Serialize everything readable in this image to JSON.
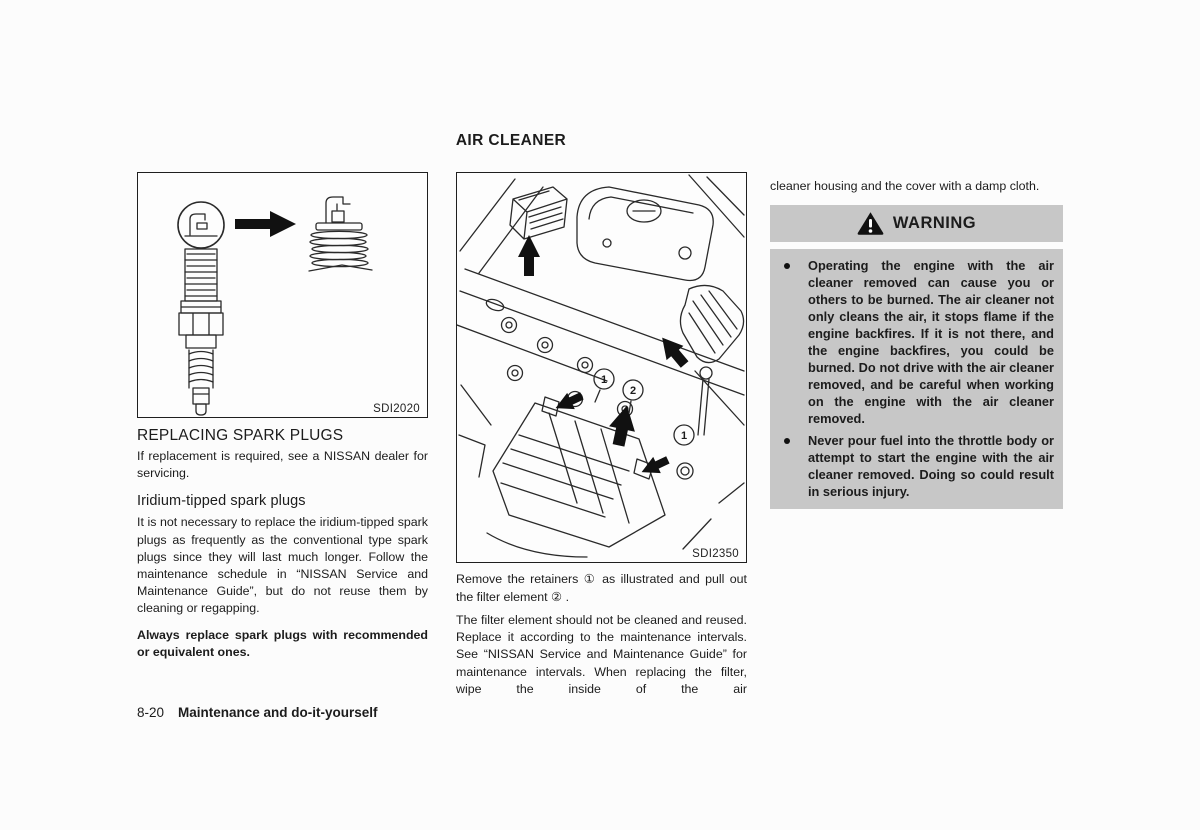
{
  "page": {
    "title": "AIR CLEANER",
    "footer": {
      "page_number": "8-20",
      "chapter": "Maintenance and do-it-yourself"
    }
  },
  "left_column": {
    "figure": {
      "label": "SDI2020"
    },
    "heading": "REPLACING SPARK PLUGS",
    "para1": "If replacement is required, see a NISSAN dealer for servicing.",
    "subheading": "Iridium-tipped spark plugs",
    "para2": "It is not necessary to replace the iridium-tipped spark plugs as frequently as the conventional type spark plugs since they will last much longer. Follow the maintenance schedule in “NISSAN Service and Maintenance Guide”, but do not reuse them by cleaning or regapping.",
    "para3_bold": "Always replace spark plugs with recommended or equivalent ones."
  },
  "middle_column": {
    "figure": {
      "label": "SDI2350",
      "callouts": [
        "1",
        "2",
        "1"
      ]
    },
    "para1": "Remove the retainers ① as illustrated and pull out the filter element ② .",
    "para2": "The filter element should not be cleaned and reused. Replace it according to the maintenance intervals. See “NISSAN Service and Maintenance Guide” for maintenance intervals. When replacing the filter, wipe the inside of the air"
  },
  "right_column": {
    "para_continued": "cleaner housing and the cover with a damp cloth.",
    "warning": {
      "title": "WARNING",
      "items": [
        "Operating the engine with the air cleaner removed can cause you or others to be burned. The air cleaner not only cleans the air, it stops flame if the engine backfires. If it is not there, and the engine backfires, you could be burned. Do not drive with the air cleaner removed, and be careful when working on the engine with the air cleaner removed.",
        "Never pour fuel into the throttle body or attempt to start the engine with the air cleaner removed. Doing so could result in serious injury."
      ]
    }
  }
}
